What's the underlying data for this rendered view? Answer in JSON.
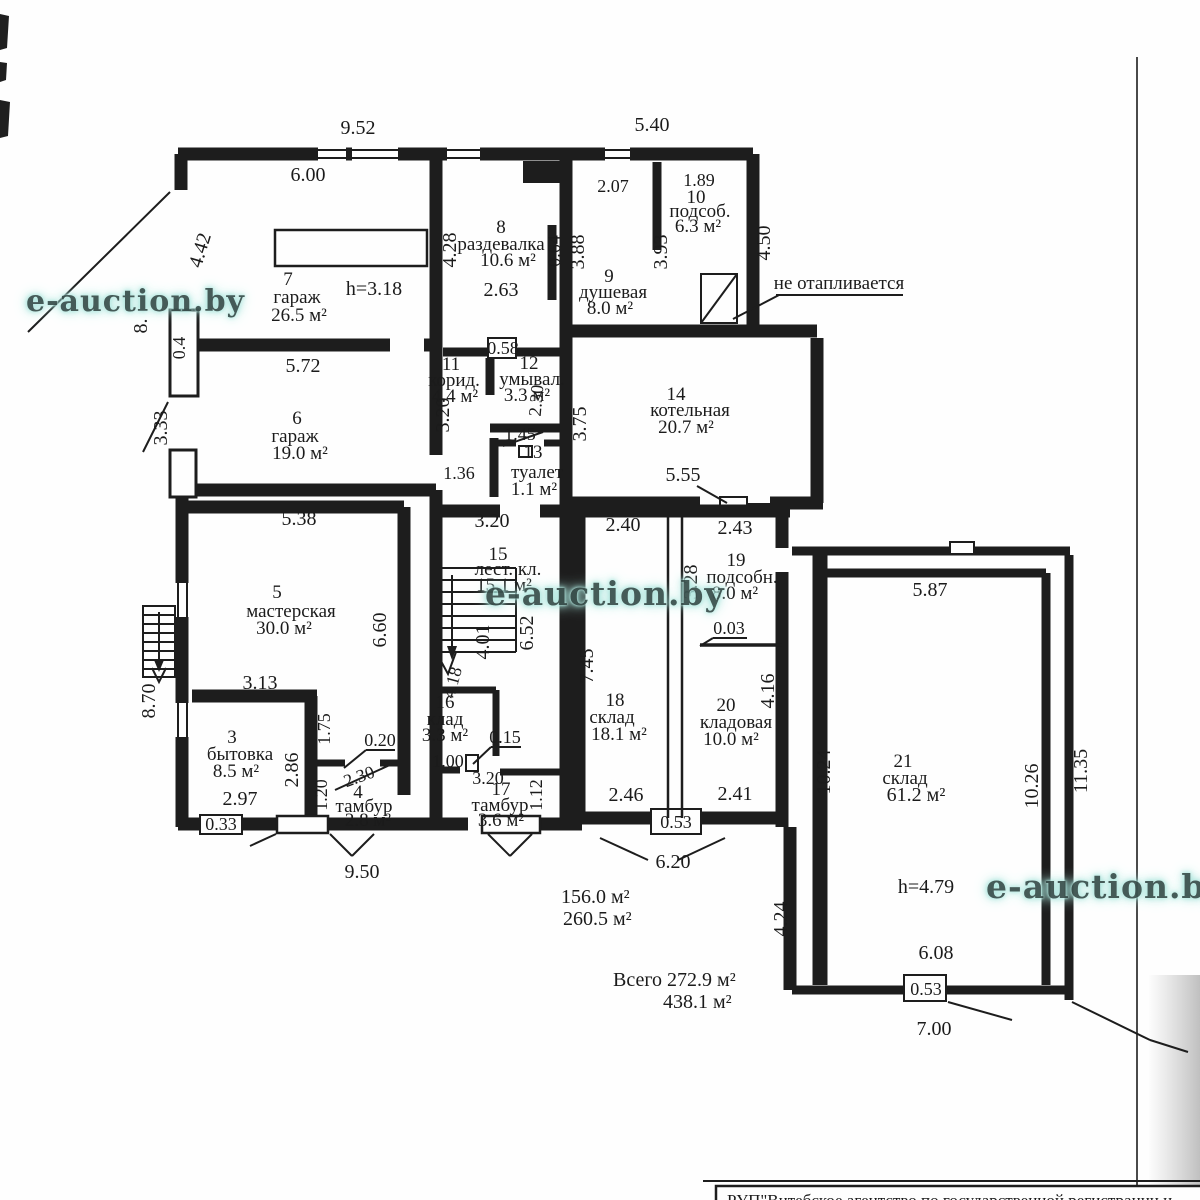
{
  "watermark": {
    "text": "e-auction.by"
  },
  "note": {
    "unheated": "не отапливается"
  },
  "footer": {
    "agency": "РУП\"Витебское агентство по государственной регистрации и"
  },
  "totals": {
    "line1": "156.0 м²",
    "line2": "260.5 м²",
    "line3": "Всего 272.9 м²",
    "line4": "438.1 м²"
  },
  "rooms": {
    "r3": {
      "num": "3",
      "name": "бытовка",
      "area": "8.5 м²"
    },
    "r4": {
      "num": "4",
      "name": "тамбур",
      "area": "2.8 м²"
    },
    "r5": {
      "num": "5",
      "name": "мастерская",
      "area": "30.0 м²"
    },
    "r6": {
      "num": "6",
      "name": "гараж",
      "area": "19.0 м²"
    },
    "r7": {
      "num": "7",
      "name": "гараж",
      "area": "26.5 м²",
      "height": "h=3.18"
    },
    "r8": {
      "num": "8",
      "name": "раздевалка",
      "area": "10.6 м²"
    },
    "r9": {
      "num": "9",
      "name": "душевая",
      "area": "8.0 м²"
    },
    "r10": {
      "num": "10",
      "name": "подсоб.",
      "area": "6.3 м²"
    },
    "r11": {
      "num": "11",
      "name": "корид.",
      "area": "4.4 м²"
    },
    "r12": {
      "num": "12",
      "name": "умывал.",
      "area": "3.3 м²"
    },
    "r13": {
      "num": "13",
      "name": "туалет",
      "area": "1.1 м²"
    },
    "r14": {
      "num": "14",
      "name": "котельная",
      "area": "20.7 м²"
    },
    "r15": {
      "num": "15",
      "name": "лест. кл.",
      "area": "15.1 м²"
    },
    "r16": {
      "num": "16",
      "name": "клад",
      "area": "3.3 м²"
    },
    "r17": {
      "num": "17",
      "name": "тамбур",
      "area": "3.6 м²"
    },
    "r18": {
      "num": "18",
      "name": "склад",
      "area": "18.1 м²"
    },
    "r19": {
      "num": "19",
      "name": "подсобн.",
      "area": "8.0 м²"
    },
    "r20": {
      "num": "20",
      "name": "кладовая",
      "area": "10.0 м²"
    },
    "r21": {
      "num": "21",
      "name": "склад",
      "area": "61.2 м²",
      "height": "h=4.79"
    }
  },
  "dims": {
    "d952": "9.52",
    "d540": "5.40",
    "d600": "6.00",
    "d442": "4.42",
    "d8": "8.",
    "d04": "0.4",
    "d207": "2.07",
    "d189": "1.89",
    "d428": "4.28",
    "d064": "0.64",
    "d388": "3.88",
    "d393": "3.93",
    "d450": "4.50",
    "d263": "2.63",
    "d058": "0.58",
    "d572": "5.72",
    "d333": "3.33",
    "d320c": "3.20",
    "d230u": "2.30",
    "d145": "1.45",
    "d136": "1.36",
    "d375": "3.75",
    "d555": "5.55",
    "d320l": "3.20",
    "d538": "5.38",
    "d660": "6.60",
    "d652": "6.52",
    "d401": "4.01",
    "d418": "4.18",
    "d240": "2.40",
    "d243": "2.43",
    "d328": "3.28",
    "d003": "0.03",
    "d745": "7.45",
    "d416": "4.16",
    "d313": "3.13",
    "d175": "1.75",
    "d286": "2.86",
    "d870": "8.70",
    "d020": "0.20",
    "d230t": "2.30",
    "d120": "1.20",
    "d015": "0.15",
    "d100": "1.00",
    "d297": "2.97",
    "d033": "0.33",
    "d320t": "3.20",
    "d112": "1.12",
    "d246": "2.46",
    "d241": "2.41",
    "d053a": "0.53",
    "d1024": "10.24",
    "d587": "5.87",
    "d1026": "10.26",
    "d1135": "11.35",
    "d950": "9.50",
    "d620": "6.20",
    "d424": "4.24",
    "dh479": "h=4.79",
    "d608": "6.08",
    "d053b": "0.53",
    "d700": "7.00",
    "dh318": "h=3.18"
  }
}
